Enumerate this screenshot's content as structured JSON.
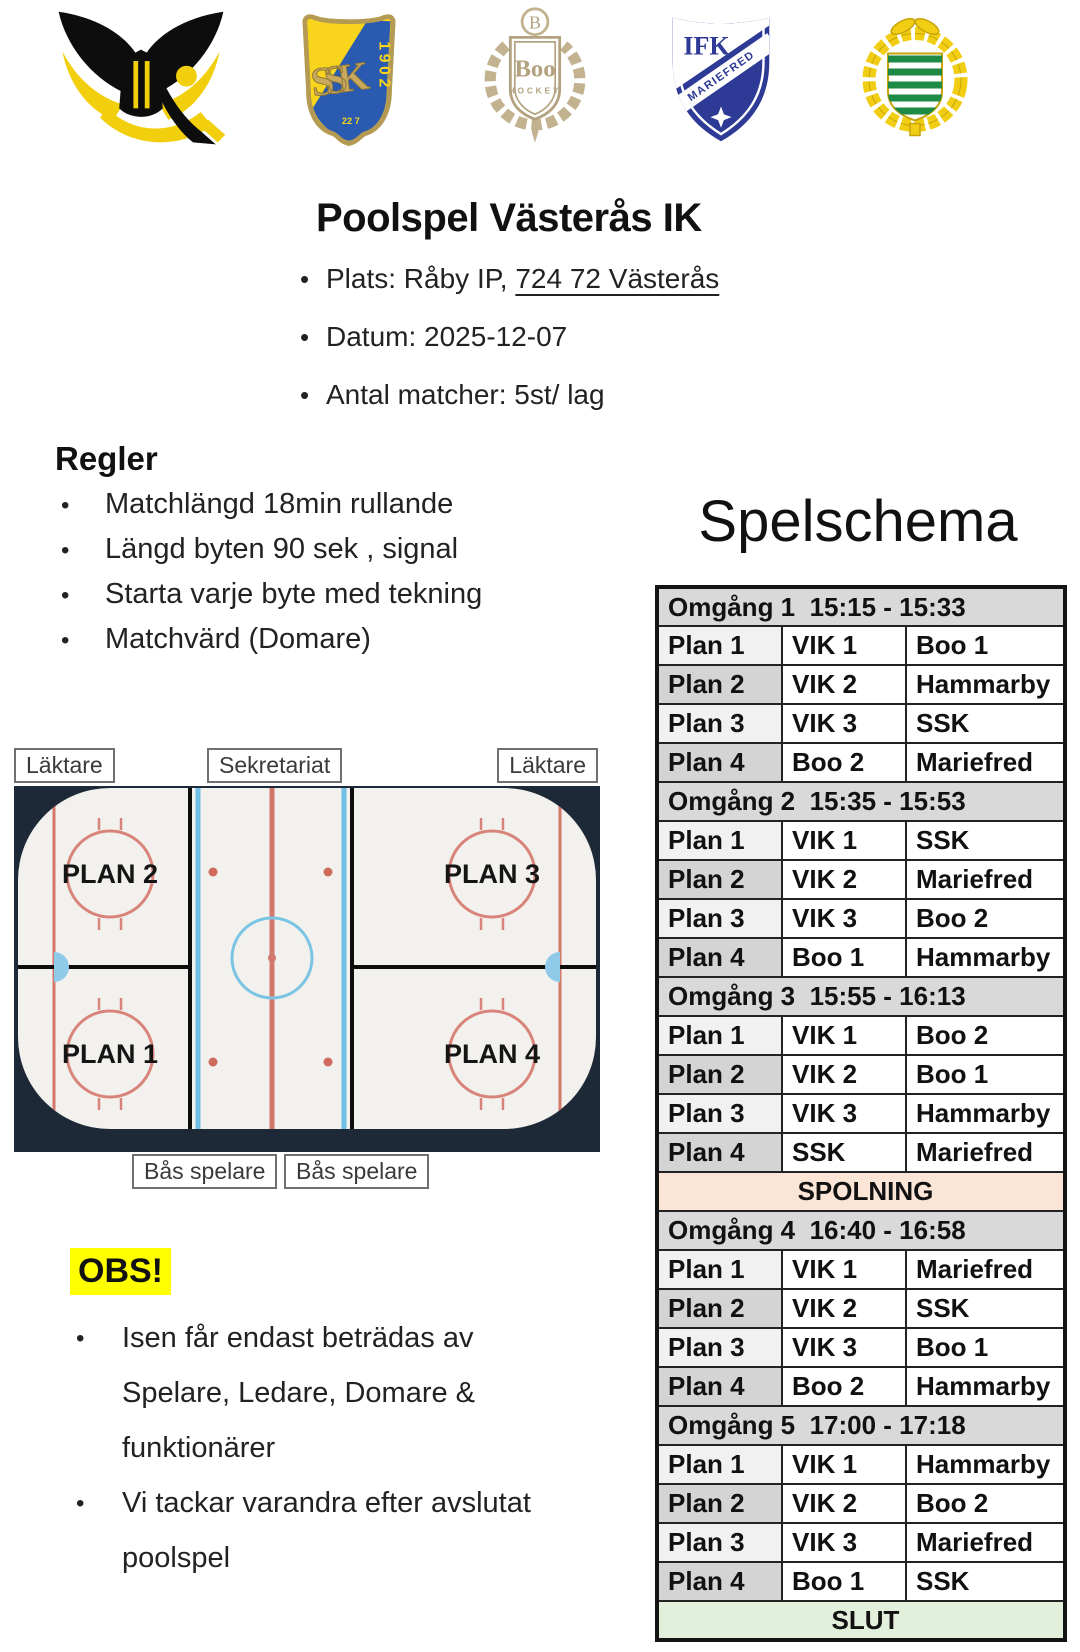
{
  "intro": {
    "title": "Poolspel Västerås IK",
    "bullets": {
      "plats_prefix": "Plats: Råby IP, ",
      "plats_address": "724 72 Västerås",
      "datum": "Datum: 2025-12-07",
      "antal": "Antal matcher: 5st/ lag"
    }
  },
  "regler": {
    "heading": "Regler",
    "items": [
      "Matchlängd 18min rullande",
      "Längd byten 90 sek , signal",
      "Starta varje byte med tekning",
      "Matchvärd (Domare)"
    ]
  },
  "schedule": {
    "title": "Spelschema",
    "rows": [
      {
        "t": "round",
        "label": "Omgång 1  15:15 - 15:33"
      },
      {
        "t": "m",
        "plan": "Plan 1",
        "home": "VIK 1",
        "away": "Boo 1"
      },
      {
        "t": "m",
        "plan": "Plan 2",
        "home": "VIK 2",
        "away": "Hammarby"
      },
      {
        "t": "m",
        "plan": "Plan 3",
        "home": "VIK 3",
        "away": "SSK"
      },
      {
        "t": "m",
        "plan": "Plan 4",
        "home": "Boo 2",
        "away": "Mariefred"
      },
      {
        "t": "round",
        "label": "Omgång 2  15:35 - 15:53"
      },
      {
        "t": "m",
        "plan": "Plan 1",
        "home": "VIK 1",
        "away": "SSK"
      },
      {
        "t": "m",
        "plan": "Plan 2",
        "home": "VIK 2",
        "away": "Mariefred"
      },
      {
        "t": "m",
        "plan": "Plan 3",
        "home": "VIK 3",
        "away": "Boo 2"
      },
      {
        "t": "m",
        "plan": "Plan 4",
        "home": "Boo 1",
        "away": "Hammarby"
      },
      {
        "t": "round",
        "label": "Omgång 3  15:55 - 16:13"
      },
      {
        "t": "m",
        "plan": "Plan 1",
        "home": "VIK 1",
        "away": "Boo 2"
      },
      {
        "t": "m",
        "plan": "Plan 2",
        "home": "VIK 2",
        "away": "Boo 1"
      },
      {
        "t": "m",
        "plan": "Plan 3",
        "home": "VIK 3",
        "away": "Hammarby"
      },
      {
        "t": "m",
        "plan": "Plan 4",
        "home": "SSK",
        "away": "Mariefred"
      },
      {
        "t": "banner",
        "kind": "spolning",
        "label": "SPOLNING"
      },
      {
        "t": "round",
        "label": "Omgång 4  16:40 - 16:58"
      },
      {
        "t": "m",
        "plan": "Plan 1",
        "home": "VIK 1",
        "away": "Mariefred"
      },
      {
        "t": "m",
        "plan": "Plan 2",
        "home": "VIK 2",
        "away": "SSK"
      },
      {
        "t": "m",
        "plan": "Plan 3",
        "home": "VIK 3",
        "away": "Boo 1"
      },
      {
        "t": "m",
        "plan": "Plan 4",
        "home": "Boo 2",
        "away": "Hammarby"
      },
      {
        "t": "round",
        "label": "Omgång 5  17:00 - 17:18"
      },
      {
        "t": "m",
        "plan": "Plan 1",
        "home": "VIK 1",
        "away": "Hammarby"
      },
      {
        "t": "m",
        "plan": "Plan 2",
        "home": "VIK 2",
        "away": "Boo 2"
      },
      {
        "t": "m",
        "plan": "Plan 3",
        "home": "VIK 3",
        "away": "Mariefred"
      },
      {
        "t": "m",
        "plan": "Plan 4",
        "home": "Boo 1",
        "away": "SSK"
      },
      {
        "t": "banner",
        "kind": "slut",
        "label": "SLUT"
      }
    ]
  },
  "rink": {
    "laktare": "Läktare",
    "sekretariat": "Sekretariat",
    "bas_spelare": "Bås spelare",
    "plans": [
      "PLAN 1",
      "PLAN 2",
      "PLAN 3",
      "PLAN 4"
    ]
  },
  "obs": {
    "heading": "OBS!",
    "items": [
      [
        "Isen får endast beträdas av",
        "Spelare, Ledare, Domare &",
        "funktionärer"
      ],
      [
        "Vi tackar varandra efter avslutat",
        "poolspel"
      ]
    ]
  },
  "logos": {
    "names": [
      "VIK",
      "SSK",
      "Boo Hockey",
      "IFK Mariefred",
      "Hammarby"
    ],
    "ssk": {
      "year": "1902",
      "small": "22 7"
    },
    "boo": {
      "initial": "B",
      "name": "Boo",
      "sub": "HOCKEY"
    },
    "ifk": {
      "top": "IFK",
      "banner": "MARIEFRED"
    }
  },
  "colors": {
    "round_header_bg": "#d9d9d9",
    "spolning_bg": "#fbe5d6",
    "slut_bg": "#e2efda",
    "obs_highlight": "#ffff00",
    "rink_dark": "#1d2936",
    "line_red": "#cf6a5c",
    "line_blue": "#6fc0e4"
  }
}
